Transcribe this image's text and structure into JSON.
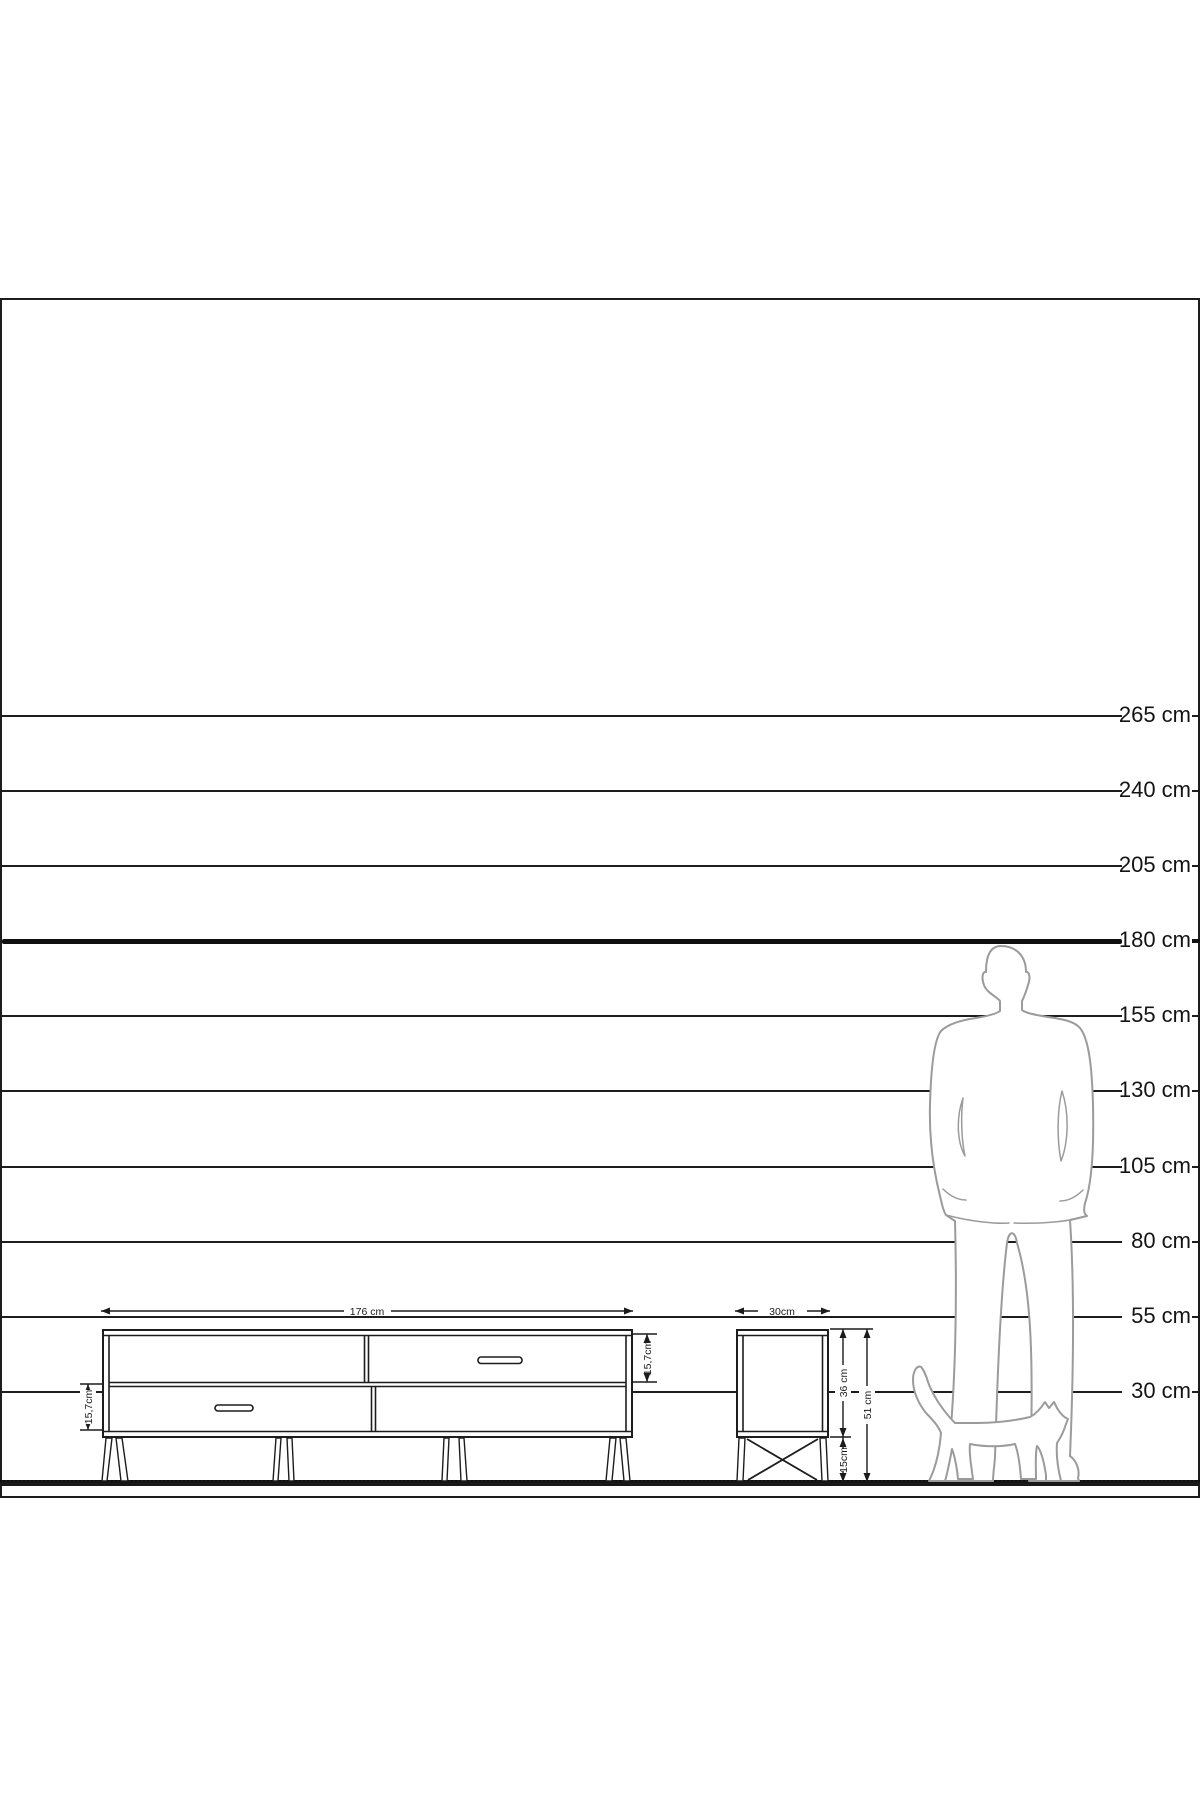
{
  "colors": {
    "background": "#ffffff",
    "line": "#1d1d1d",
    "figure_outline": "#9b9b9b",
    "reference_line": "#101010"
  },
  "scale": {
    "unit": "cm",
    "labels": [
      "265 cm",
      "240 cm",
      "205 cm",
      "180 cm",
      "155 cm",
      "130 cm",
      "105 cm",
      "80 cm",
      "55 cm",
      "30 cm"
    ],
    "reference_height": "180 cm"
  },
  "tv_stand": {
    "width_label": "176 cm",
    "bottom_drawer_label": "15,7cm",
    "top_drawer_label": "15,7cm"
  },
  "side_table": {
    "width_label": "30cm",
    "body_height_label": "36 cm",
    "leg_height_label": "15cm",
    "total_height_label": "51 cm"
  },
  "figures": {
    "person": "man-silhouette",
    "cat": "cat-silhouette"
  }
}
